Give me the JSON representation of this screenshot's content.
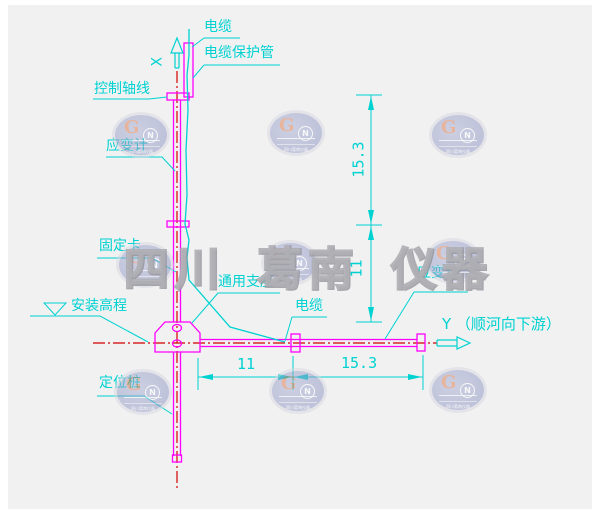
{
  "watermark": {
    "text": "四川 葛南 仪器",
    "logo": {
      "g": "G",
      "n": "N",
      "caption": "四川葛南仪器"
    }
  },
  "labels": {
    "cable_top": "电缆",
    "cable_pipe": "电缆保护管",
    "control_axis": "控制轴线",
    "strain_gauge_left": "应变计",
    "fixing_clamp": "固定卡",
    "universal_support": "通用支座",
    "install_elevation": "安装高程",
    "positioning_pile": "定位桩",
    "strain_gauge_right": "应变计",
    "cable_right": "电缆",
    "axis_x": "X",
    "axis_y": "Y （顺河向下游）"
  },
  "dimensions": {
    "vertical_upper": "15.3",
    "vertical_lower": "11",
    "horizontal_left": "11",
    "horizontal_right": "15.3"
  },
  "colors": {
    "annotation_cyan": "#00d2d2",
    "structure_magenta": "#ff00ff",
    "centerline_red": "#d40000",
    "canvas_bg": "#f1f1f1"
  }
}
